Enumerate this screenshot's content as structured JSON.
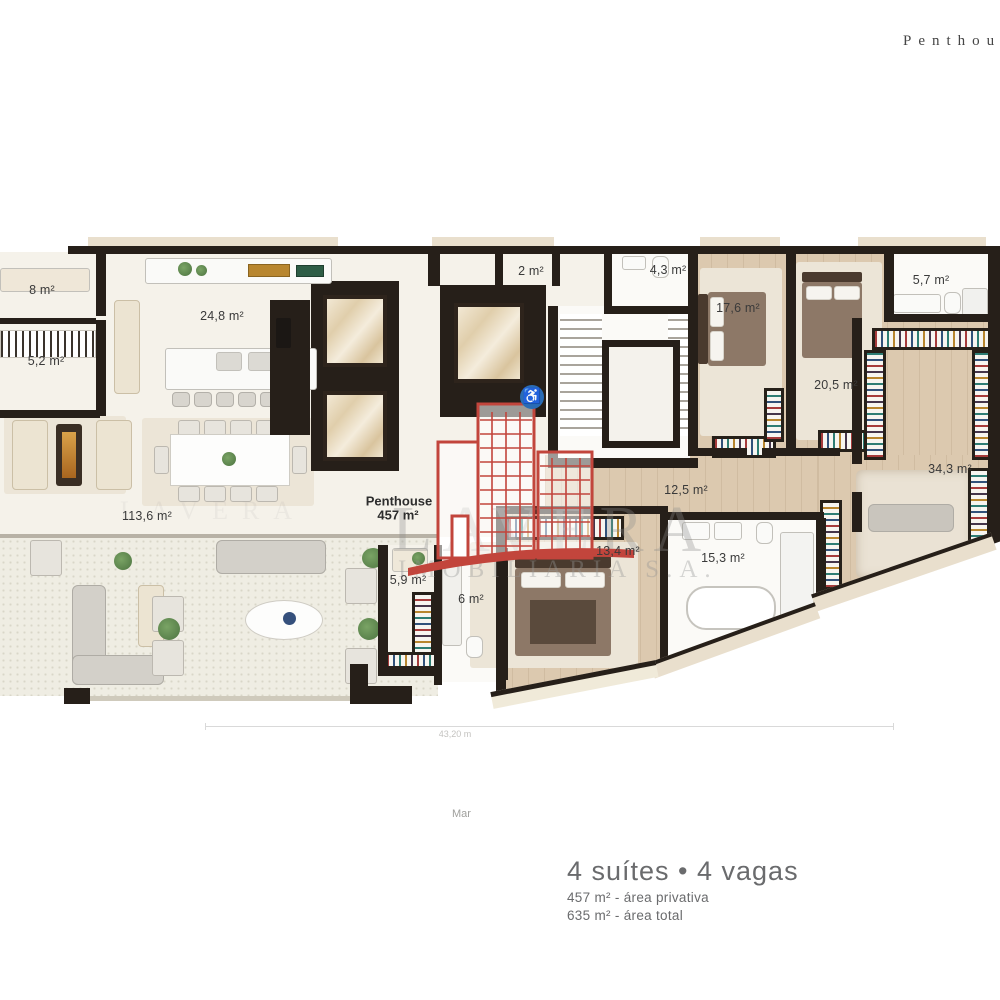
{
  "header": {
    "edge_label": "Penthouse"
  },
  "unit": {
    "name": "Penthouse",
    "area": "457 m²"
  },
  "rooms": {
    "laundry": "8 m²",
    "pantry": "5,2 m²",
    "kitchen": "24,8 m²",
    "hall": "2 m²",
    "bath_social": "4,3 m²",
    "suite2": "17,6 m²",
    "suite3": "20,5 m²",
    "bath_top": "5,7 m²",
    "master": "34,3 m²",
    "corridor": "12,5 m²",
    "suite4": "13,4 m²",
    "master_bath": "15,3 m²",
    "closet": "5,9 m²",
    "bath6": "6 m²",
    "living": "113,6 m²"
  },
  "watermark": {
    "title": "LAVERA",
    "subtitle": "IMOBILIÁRIA S.A."
  },
  "annotations": {
    "width_dim": "43,20 m",
    "sea": "Mar"
  },
  "footer": {
    "headline": "4 suítes • 4 vagas",
    "private_area": "457 m² - área privativa",
    "total_area": "635 m² - área total"
  },
  "colors": {
    "wall": "#261f19",
    "wood": "#dcc9af",
    "logo_red": "#c2453c",
    "accent_blue": "#2a6cb5"
  }
}
